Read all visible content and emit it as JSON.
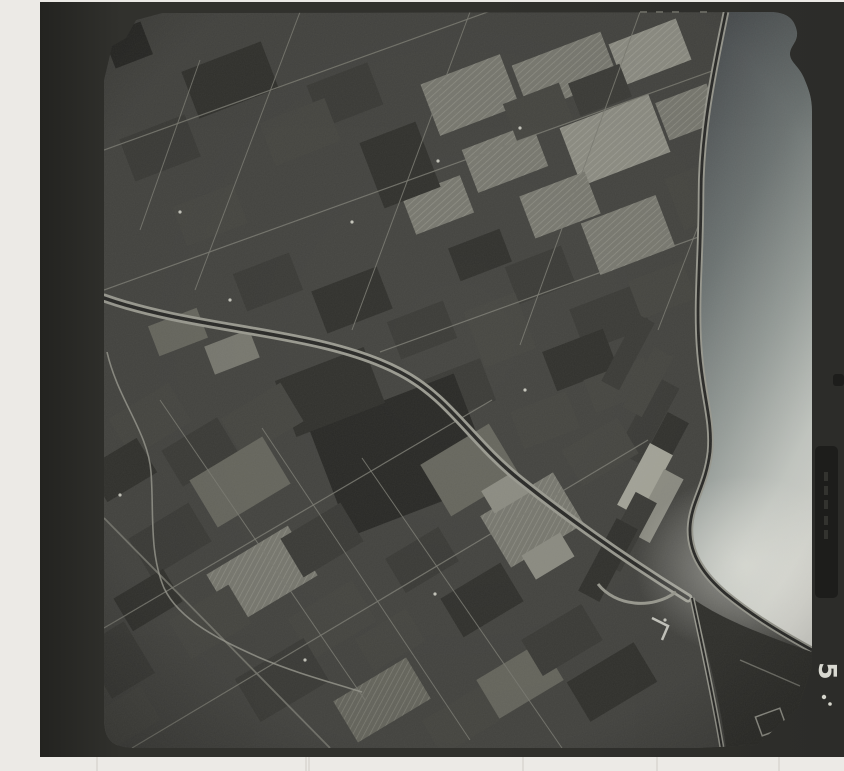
{
  "frame": {
    "label": "5"
  },
  "colors": {
    "page_bg": "#eceae6",
    "frame_edge": "#232320",
    "frame_mid": "#31312d",
    "frame_right": "#2c2c29",
    "photo_base": "#454541",
    "road": "#7d7d74",
    "levee": "#9c9c92",
    "channel": "#2a2a28",
    "speck": "#d6d6cc",
    "jetty": "#c8c8c0",
    "corner_fields": "#31312d",
    "tab": "#1d1d1b",
    "tick": "#6f6f68",
    "streak": "#cfccc7",
    "water_stops": [
      "#4d5153",
      "#6f7675",
      "#9aa19d",
      "#c9cdc7",
      "#dfdfd8"
    ],
    "tones": {
      "d2": "#2a2a27",
      "d1": "#32322e",
      "m2": "#3c3c38",
      "m1": "#474742",
      "l1": "#55554f",
      "l2": "#68685f",
      "l3": "#7a7a71",
      "b1": "#8e8e84",
      "b2": "#a6a69a"
    }
  },
  "scene": {
    "photo_outline": "M104,80 L112,46 L126,38 L136,20 L162,13 L770,12 C788,12 795,20 797,32 C798,42 790,46 790,54 C790,62 799,66 804,78 C809,90 812,98 812,112 L812,652 L812,666 L798,708 L757,745 L700,748 L136,748 C112,748 104,740 104,718 Z",
    "water": "M726,12 C714,70 701,130 701,195 C701,255 696,300 699,345 C702,395 713,418 710,452 C706,486 691,502 690,528 C689,556 706,577 726,594 C748,612 772,628 812,650 L812,12 Z",
    "right_river": "M726,12 C714,70 701,130 701,195 C701,255 696,300 699,345 C702,395 713,418 710,452 C706,486 691,502 690,528 C689,556 706,577 726,594 C748,612 772,628 812,650",
    "canal": "M104,298 C200,332 320,330 400,372 C450,398 470,440 520,480 C560,512 620,556 688,598",
    "creek": "M107,352 C118,400 148,432 151,472 C154,512 149,552 164,588 C180,622 225,642 258,657 C295,673 330,682 362,692",
    "u_loop": "M598,584 C615,606 652,610 676,592",
    "jetty": "M652,618 L668,626 L662,640",
    "corner_fields_d": "M692,598 C714,614 748,630 812,652 L812,666 L798,708 L757,745 L726,748 C720,700 706,644 692,598 Z",
    "mouth_channel": "M692,598 C702,644 714,700 722,748",
    "corner_road": "M740,660 L800,686",
    "patches": [
      [
        470,
        95,
        85,
        55,
        -21,
        "l3",
        1
      ],
      [
        565,
        72,
        95,
        50,
        -21,
        "l3",
        1
      ],
      [
        650,
        52,
        72,
        44,
        -21,
        "b1",
        1
      ],
      [
        505,
        158,
        75,
        46,
        -21,
        "l3",
        1
      ],
      [
        615,
        140,
        95,
        62,
        -21,
        "b1",
        1
      ],
      [
        688,
        112,
        55,
        40,
        -21,
        "l3",
        1
      ],
      [
        438,
        205,
        62,
        40,
        -21,
        "l3",
        1
      ],
      [
        560,
        205,
        70,
        45,
        -21,
        "l3",
        1
      ],
      [
        628,
        235,
        80,
        55,
        -21,
        "l3",
        1
      ],
      [
        538,
        112,
        60,
        40,
        -21,
        "m1",
        0
      ],
      [
        600,
        90,
        55,
        35,
        -21,
        "m2",
        0
      ],
      [
        700,
        195,
        55,
        55,
        -21,
        "m1",
        0
      ],
      [
        540,
        275,
        60,
        40,
        -21,
        "m2",
        0
      ],
      [
        480,
        255,
        55,
        35,
        -21,
        "d1",
        0
      ],
      [
        400,
        165,
        60,
        70,
        -21,
        "d1",
        0
      ],
      [
        345,
        95,
        65,
        45,
        -21,
        "m2",
        0
      ],
      [
        230,
        80,
        85,
        50,
        -21,
        "d1",
        0
      ],
      [
        300,
        132,
        70,
        46,
        -21,
        "m1",
        0
      ],
      [
        160,
        148,
        70,
        45,
        -21,
        "m2",
        0
      ],
      [
        210,
        215,
        65,
        42,
        -21,
        "m1",
        0
      ],
      [
        268,
        282,
        60,
        40,
        -21,
        "m2",
        0
      ],
      [
        352,
        300,
        70,
        45,
        -21,
        "d1",
        0
      ],
      [
        422,
        330,
        60,
        40,
        -21,
        "m2",
        0
      ],
      [
        610,
        318,
        70,
        45,
        -21,
        "m2",
        0
      ],
      [
        662,
        290,
        58,
        40,
        -21,
        "m1",
        0
      ],
      [
        580,
        360,
        65,
        42,
        -21,
        "d1",
        0
      ],
      [
        128,
        45,
        40,
        35,
        -21,
        "d2",
        0
      ],
      [
        178,
        332,
        52,
        32,
        -21,
        "l2",
        0
      ],
      [
        232,
        352,
        48,
        30,
        -21,
        "l3",
        0
      ],
      [
        620,
        385,
        65,
        35,
        -21,
        "m1",
        0
      ],
      [
        500,
        330,
        55,
        60,
        -21,
        "m1",
        0
      ],
      [
        460,
        390,
        60,
        45,
        -21,
        "m2",
        0
      ],
      [
        545,
        420,
        60,
        40,
        -21,
        "m1",
        0
      ],
      [
        402,
        455,
        155,
        115,
        -21,
        "d2",
        0
      ],
      [
        330,
        392,
        95,
        60,
        -21,
        "d1",
        0
      ],
      [
        648,
        420,
        85,
        26,
        -62,
        "m2",
        0
      ],
      [
        660,
        452,
        78,
        24,
        -62,
        "d1",
        0
      ],
      [
        645,
        480,
        70,
        26,
        -62,
        "b2",
        0
      ],
      [
        657,
        506,
        72,
        22,
        -62,
        "b1",
        0
      ],
      [
        628,
        532,
        78,
        24,
        -62,
        "m2",
        0
      ],
      [
        608,
        560,
        82,
        24,
        -62,
        "d1",
        0
      ],
      [
        648,
        382,
        68,
        22,
        -62,
        "m1",
        0
      ],
      [
        628,
        352,
        76,
        20,
        -62,
        "m2",
        0
      ],
      [
        150,
        420,
        70,
        45,
        -31,
        "m1",
        0
      ],
      [
        122,
        470,
        58,
        40,
        -31,
        "d1",
        0
      ],
      [
        200,
        452,
        65,
        42,
        -31,
        "m2",
        0
      ],
      [
        262,
        420,
        70,
        45,
        -31,
        "m1",
        0
      ],
      [
        240,
        482,
        85,
        55,
        -31,
        "l2",
        0
      ],
      [
        170,
        540,
        70,
        45,
        -31,
        "m2",
        0
      ],
      [
        262,
        575,
        95,
        58,
        -31,
        "l3",
        1
      ],
      [
        210,
        622,
        70,
        45,
        -31,
        "m1",
        0
      ],
      [
        148,
        600,
        58,
        38,
        -31,
        "d1",
        0
      ],
      [
        322,
        540,
        70,
        45,
        -31,
        "m2",
        0
      ],
      [
        332,
        620,
        75,
        48,
        -31,
        "m1",
        0
      ],
      [
        282,
        680,
        80,
        50,
        -31,
        "m2",
        0
      ],
      [
        382,
        700,
        85,
        48,
        -31,
        "l2",
        1
      ],
      [
        462,
        720,
        70,
        40,
        -31,
        "m1",
        0
      ],
      [
        520,
        680,
        75,
        45,
        -31,
        "l2",
        0
      ],
      [
        562,
        640,
        70,
        42,
        -31,
        "m2",
        0
      ],
      [
        612,
        682,
        78,
        46,
        -31,
        "d1",
        0
      ],
      [
        482,
        600,
        70,
        45,
        -31,
        "d1",
        0
      ],
      [
        422,
        560,
        62,
        40,
        -31,
        "m2",
        0
      ],
      [
        470,
        470,
        80,
        60,
        -31,
        "l2",
        0
      ],
      [
        532,
        520,
        85,
        60,
        -31,
        "l3",
        1
      ],
      [
        600,
        452,
        65,
        42,
        -31,
        "m1",
        0
      ],
      [
        390,
        640,
        60,
        38,
        -31,
        "m1",
        0
      ],
      [
        118,
        660,
        50,
        60,
        -31,
        "m2",
        0
      ],
      [
        125,
        718,
        60,
        40,
        -31,
        "m1",
        0
      ],
      [
        505,
        492,
        40,
        26,
        -31,
        "b1",
        0
      ],
      [
        548,
        556,
        45,
        28,
        -31,
        "b1",
        0
      ]
    ],
    "roads": [
      [
        104,
        150,
        660,
        -50,
        1.2
      ],
      [
        104,
        290,
        812,
        35,
        1.2
      ],
      [
        380,
        352,
        812,
        196,
        1.2
      ],
      [
        300,
        12,
        195,
        290,
        1.0
      ],
      [
        470,
        12,
        352,
        330,
        1.0
      ],
      [
        640,
        12,
        520,
        345,
        1.0
      ],
      [
        770,
        40,
        658,
        330,
        1.0
      ],
      [
        200,
        60,
        140,
        230,
        1.0
      ],
      [
        104,
        628,
        492,
        400,
        1.2
      ],
      [
        132,
        748,
        648,
        440,
        1.2
      ],
      [
        104,
        518,
        330,
        748,
        1.8
      ],
      [
        160,
        400,
        365,
        700,
        1.0
      ],
      [
        262,
        428,
        470,
        740,
        1.0
      ],
      [
        362,
        458,
        562,
        748,
        1.0
      ]
    ],
    "specks": [
      [
        520,
        128
      ],
      [
        438,
        161
      ],
      [
        180,
        212
      ],
      [
        525,
        390
      ],
      [
        435,
        594
      ],
      [
        305,
        660
      ],
      [
        120,
        495
      ],
      [
        665,
        620
      ],
      [
        352,
        222
      ],
      [
        230,
        300
      ]
    ],
    "ticks_x": [
      640,
      656,
      672,
      700
    ],
    "tab": {
      "x": 815,
      "y": 446,
      "w": 23,
      "h": 152,
      "nub_y": 374
    },
    "tab_dashes_y": [
      472,
      486,
      500,
      516,
      530
    ],
    "dots": [
      [
        824,
        697,
        2.2
      ],
      [
        830,
        704,
        1.8
      ]
    ],
    "streaks_x": [
      97,
      306,
      309,
      523,
      657,
      779
    ]
  }
}
